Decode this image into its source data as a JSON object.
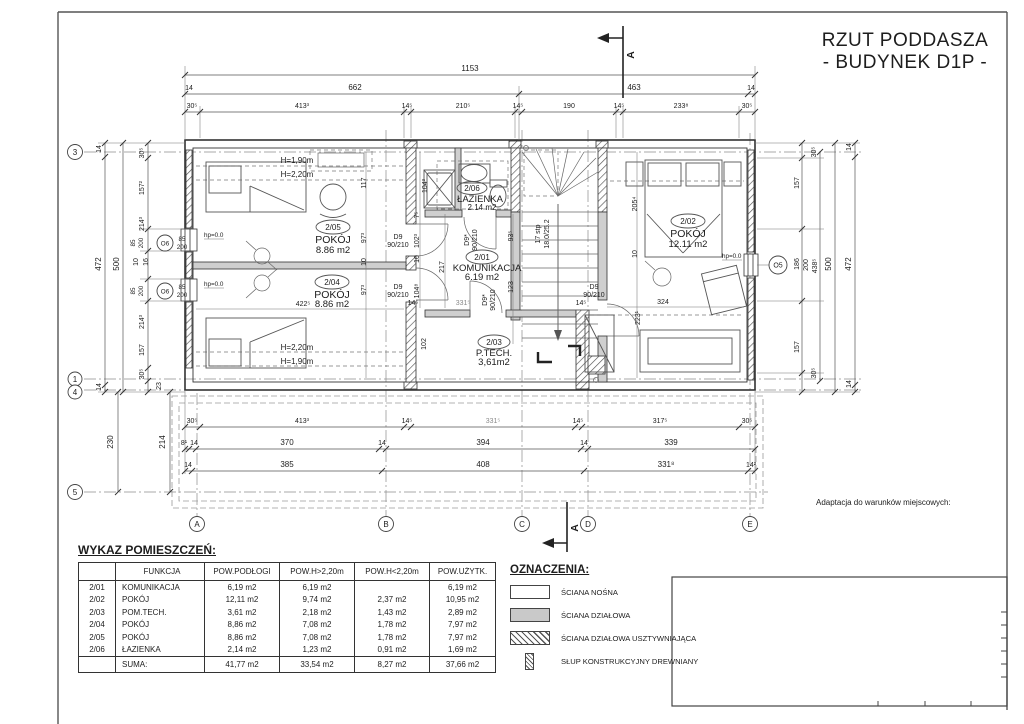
{
  "title": {
    "line1": "RZUT PODDASZA",
    "line2": "- BUDYNEK D1P -"
  },
  "note": "Adaptacja do warunków miejscowych:",
  "section": {
    "label": "A"
  },
  "grid": {
    "g3": "3",
    "g1": "1",
    "g4": "4",
    "g5": "5",
    "gA": "A",
    "gB": "B",
    "gC": "C",
    "gD": "D",
    "gE": "E"
  },
  "windows": {
    "o6": "O6",
    "o5": "O5",
    "s85": "85",
    "s200": "200"
  },
  "rooms": {
    "r205": {
      "no": "2/05",
      "name": "POKÓJ",
      "area": "8.86 m2"
    },
    "r204": {
      "no": "2/04",
      "name": "POKÓJ",
      "area": "8.86 m2"
    },
    "r206": {
      "no": "2/06",
      "name": "ŁAZIENKA",
      "area": "2.14 m2"
    },
    "r201": {
      "no": "2/01",
      "name": "KOMUNIKACJA",
      "area": "6.19 m2"
    },
    "r202": {
      "no": "2/02",
      "name": "POKÓJ",
      "area": "12.11 m2"
    },
    "r203": {
      "no": "2/03",
      "name": "P.TECH.",
      "area": "3,61m2"
    }
  },
  "doors": {
    "d9": "D9",
    "d9s": "D9*",
    "size": "90/210"
  },
  "stairs": {
    "l1": "17 stp",
    "l2": "18.0/25.2"
  },
  "heights": {
    "h190": "H=1,90m",
    "h220": "H=2,20m"
  },
  "hp": "hp=0.0",
  "dims": {
    "t1": [
      "1153"
    ],
    "t2": [
      "14",
      "662",
      "463",
      "14"
    ],
    "t3": [
      "30⁵",
      "413³",
      "14⁵",
      "210⁵",
      "14⁵",
      "190",
      "14⁵",
      "233⁸",
      "30⁵"
    ],
    "b1": [
      "30⁵",
      "413³",
      "14⁵",
      "331⁵",
      "14⁵",
      "317⁵",
      "30⁵"
    ],
    "b2": [
      "8¹",
      "14",
      "370",
      "14",
      "394",
      "14",
      "339"
    ],
    "b3": [
      "14",
      "385",
      "408",
      "331⁸",
      "14²"
    ],
    "l1": [
      "14",
      "472",
      "14"
    ],
    "l2": [
      "500"
    ],
    "l3": [
      "30⁵",
      "157²",
      "214³",
      "10",
      "16",
      "214³",
      "157",
      "30⁵",
      "23"
    ],
    "lb": [
      "230",
      "214"
    ],
    "r1": [
      "30⁵",
      "157",
      "186",
      "200",
      "438⁵",
      "157",
      "30⁵"
    ],
    "r2": [
      "500"
    ],
    "r3": [
      "14",
      "472",
      "14"
    ],
    "inner": [
      "117",
      "97³",
      "10",
      "97³",
      "422⁵",
      "104³",
      "7⁵",
      "102³",
      "10",
      "104⁸",
      "217",
      "331⁵",
      "14⁵",
      "93⁵",
      "123",
      "102",
      "205⁴",
      "10",
      "324",
      "223¹",
      "14⁵"
    ]
  },
  "table": {
    "title": "WYKAZ POMIESZCZEŃ:",
    "headers": [
      "",
      "FUNKCJA",
      "POW.PODŁOGI",
      "POW.H>2,20m",
      "POW.H<2,20m",
      "POW.UŻYTK."
    ],
    "rows": [
      [
        "2/01",
        "KOMUNIKACJA",
        "6,19 m2",
        "6,19 m2",
        "",
        "6,19 m2"
      ],
      [
        "2/02",
        "POKÓJ",
        "12,11 m2",
        "9,74 m2",
        "2,37 m2",
        "10,95 m2"
      ],
      [
        "2/03",
        "POM.TECH.",
        "3,61 m2",
        "2,18 m2",
        "1,43 m2",
        "2,89 m2"
      ],
      [
        "2/04",
        "POKÓJ",
        "8,86 m2",
        "7,08 m2",
        "1,78 m2",
        "7,97 m2"
      ],
      [
        "2/05",
        "POKÓJ",
        "8,86 m2",
        "7,08 m2",
        "1,78 m2",
        "7,97 m2"
      ],
      [
        "2/06",
        "ŁAZIENKA",
        "2,14 m2",
        "1,23 m2",
        "0,91 m2",
        "1,69 m2"
      ]
    ],
    "suma": [
      "",
      "SUMA:",
      "41,77 m2",
      "33,54 m2",
      "8,27 m2",
      "37,66 m2"
    ]
  },
  "legend": {
    "title": "OZNACZENIA:",
    "items": [
      {
        "label": "ŚCIANA NOŚNA"
      },
      {
        "label": "ŚCIANA DZIAŁOWA"
      },
      {
        "label": "ŚCIANA DZIAŁOWA USZTYWNIAJĄCA"
      },
      {
        "label": "SŁUP KONSTRUKCYJNY DREWNIANY"
      }
    ]
  }
}
